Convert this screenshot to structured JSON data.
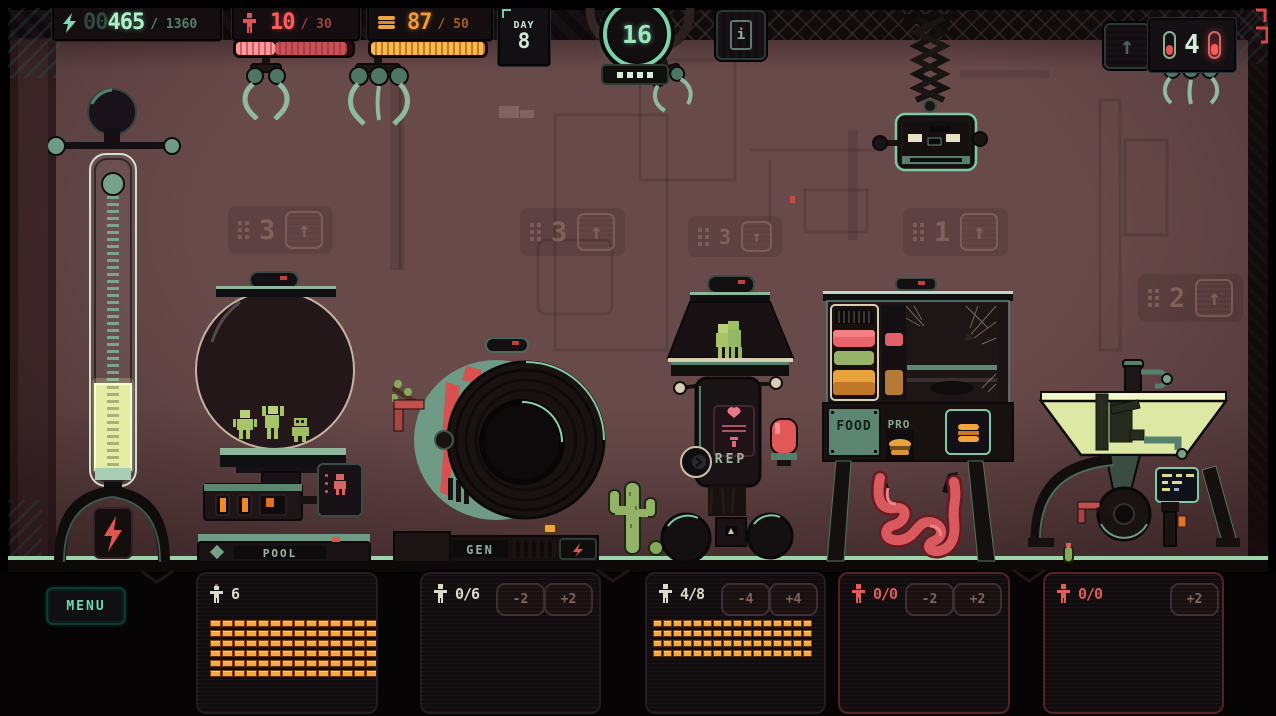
{
  "colors": {
    "accent_teal": "#8fd8b4",
    "alert_red": "#e85a5a",
    "amber": "#f0a43c",
    "wall": "#694a4b"
  },
  "hud": {
    "energy": {
      "icon": "lightning-icon",
      "pad": "00",
      "value": "465",
      "max": "/ 1360"
    },
    "population": {
      "icon": "person-icon",
      "value": "10",
      "max": "/ 30"
    },
    "food": {
      "icon": "burger-icon",
      "value": "87",
      "max": "/ 50"
    },
    "day": {
      "label": "DAY",
      "value": "8"
    },
    "cycle": {
      "value": "16",
      "dots": 4
    },
    "storage": {
      "value": "4"
    }
  },
  "world": {
    "machines": {
      "pool": {
        "label": "POOL"
      },
      "gen": {
        "label": "GEN"
      },
      "rep": {
        "label": "REP"
      },
      "food": {
        "label_left": "FOOD",
        "label_right": "PRO"
      }
    },
    "plaques": [
      {
        "num": "3"
      },
      {
        "num": "3"
      },
      {
        "num": "3"
      },
      {
        "num": "1"
      },
      {
        "num": "2"
      }
    ]
  },
  "bottom": {
    "menu_label": "MENU",
    "panels": [
      {
        "count": "6",
        "storage_rows": 6
      },
      {
        "count": "0/6",
        "dec": "-2",
        "inc": "+2",
        "storage_rows": 0
      },
      {
        "count": "4/8",
        "dec": "-4",
        "inc": "+4",
        "storage_rows": 4
      },
      {
        "count": "0/0",
        "dec": "-2",
        "inc": "+2",
        "storage_rows": 0
      },
      {
        "count": "0/0",
        "inc": "+2",
        "storage_rows": 0
      }
    ]
  }
}
